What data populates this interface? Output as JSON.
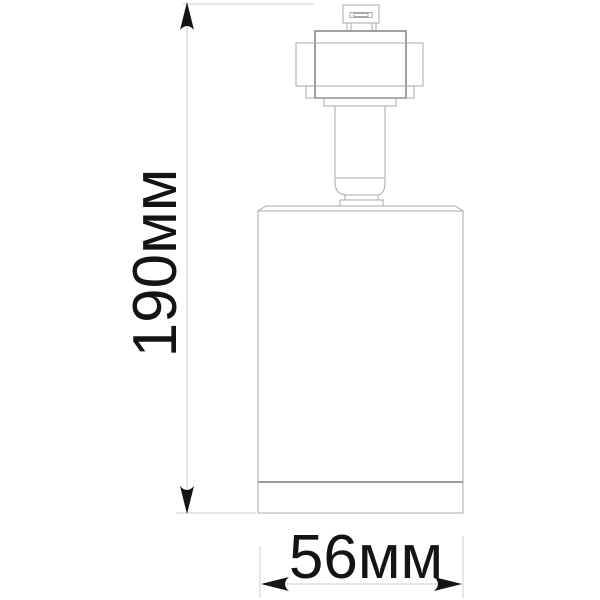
{
  "figure": {
    "type": "technical-drawing",
    "subject": "track-spotlight-dimension-drawing",
    "dimensions": {
      "height": {
        "label": "190мм",
        "value": 190,
        "unit": "мм",
        "orientation": "vertical"
      },
      "width": {
        "label": "56мм",
        "value": 56,
        "unit": "мм",
        "orientation": "horizontal"
      }
    },
    "parts": [
      "track-connector",
      "adapter-housing",
      "stem",
      "swivel-joint",
      "lamp-body",
      "bottom-trim-ring"
    ]
  },
  "colors": {
    "background": "#ffffff",
    "outline": "#a6a8ab",
    "outline_dark": "#8d8f92",
    "dim_line": "#cccccc",
    "ink": "#141414"
  }
}
